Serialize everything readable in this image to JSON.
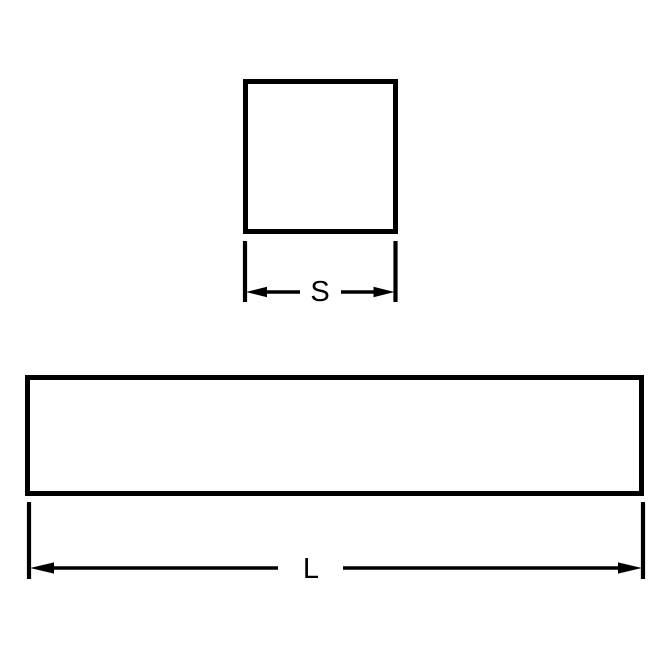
{
  "diagram": {
    "kind": "square-bar-dimension-drawing",
    "colors": {
      "line": "#000000",
      "background": "#ffffff"
    },
    "square_view": {
      "dimension_label": "S"
    },
    "bar_view": {
      "dimension_label": "L"
    }
  }
}
